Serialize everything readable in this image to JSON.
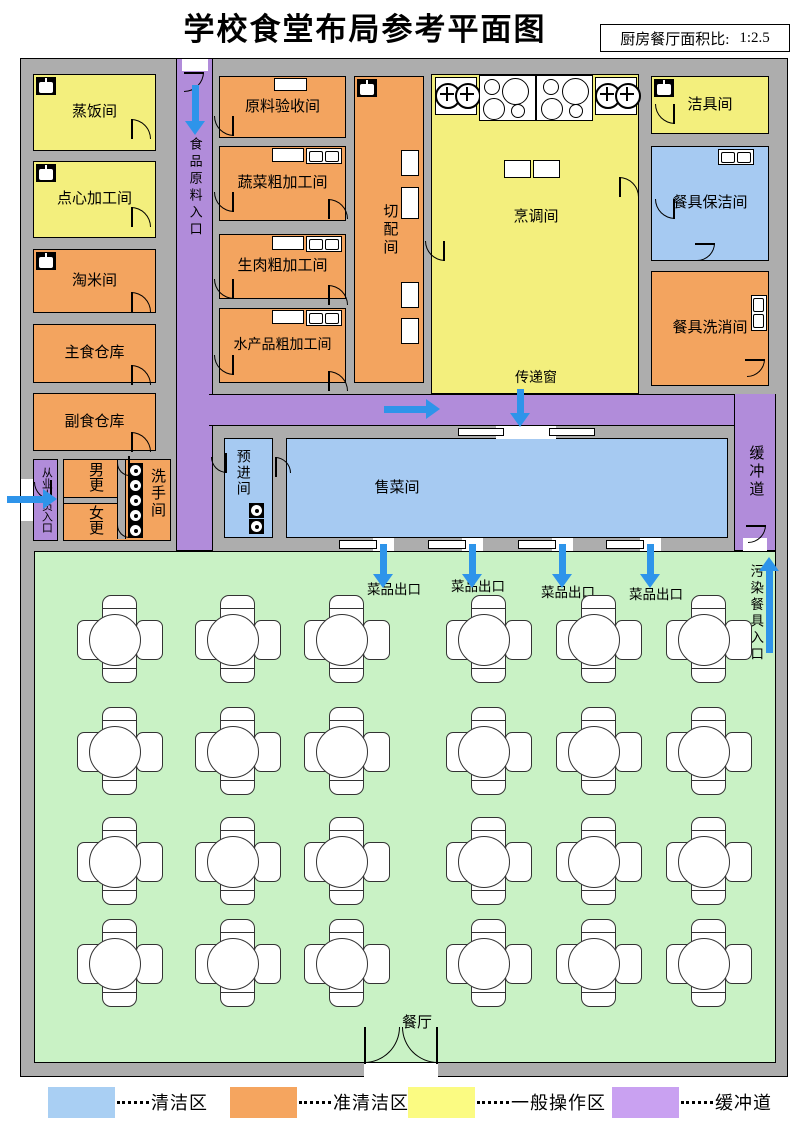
{
  "header": {
    "title": "学校食堂布局参考平面图",
    "ratio_label": "厨房餐厅面积比:",
    "ratio_value": "1:2.5"
  },
  "colors": {
    "wall": "#ADADAD",
    "clean": "#A6CAF2",
    "semi_clean": "#F3A45F",
    "general_operation": "#F3EF7D",
    "buffer": "#B18CDA",
    "dining": "#C9F2C5",
    "arrow": "#2E94EA"
  },
  "rooms": {
    "steaming": "蒸饭间",
    "snack": "点心加工间",
    "rice_wash": "淘米间",
    "staple_warehouse": "主食仓库",
    "side_warehouse": "副食仓库",
    "male_changing": "男更",
    "female_changing": "女更",
    "washroom": "洗手间",
    "staff_entrance": "从业人员入口",
    "ingredient_entrance": "食品原料入口",
    "acceptance": "原料验收间",
    "vegetable": "蔬菜粗加工间",
    "raw_meat": "生肉粗加工间",
    "aquatic": "水产品粗加工间",
    "cutting": "切配间",
    "cooking": "烹调间",
    "transfer_window": "传递窗",
    "cleaning_tools": "洁具间",
    "tableware_cleankeep": "餐具保洁间",
    "tableware_washing": "餐具洗消间",
    "selling": "售菜间",
    "pre_entry": "预进间",
    "buffer_corridor": "缓冲道",
    "dish_exit": "菜品出口",
    "dirty_tableware_entrance": "污染餐具入口",
    "dining_hall": "餐厅"
  },
  "dining": {
    "table_grid": {
      "rows": 4,
      "cols": 6
    }
  },
  "legend": {
    "items": [
      {
        "label": "清洁区",
        "color": "#A9CFF3"
      },
      {
        "label": "准清洁区",
        "color": "#F5A55F"
      },
      {
        "label": "一般操作区",
        "color": "#FBFB82"
      },
      {
        "label": "缓冲道",
        "color": "#C9A1F1"
      }
    ]
  }
}
